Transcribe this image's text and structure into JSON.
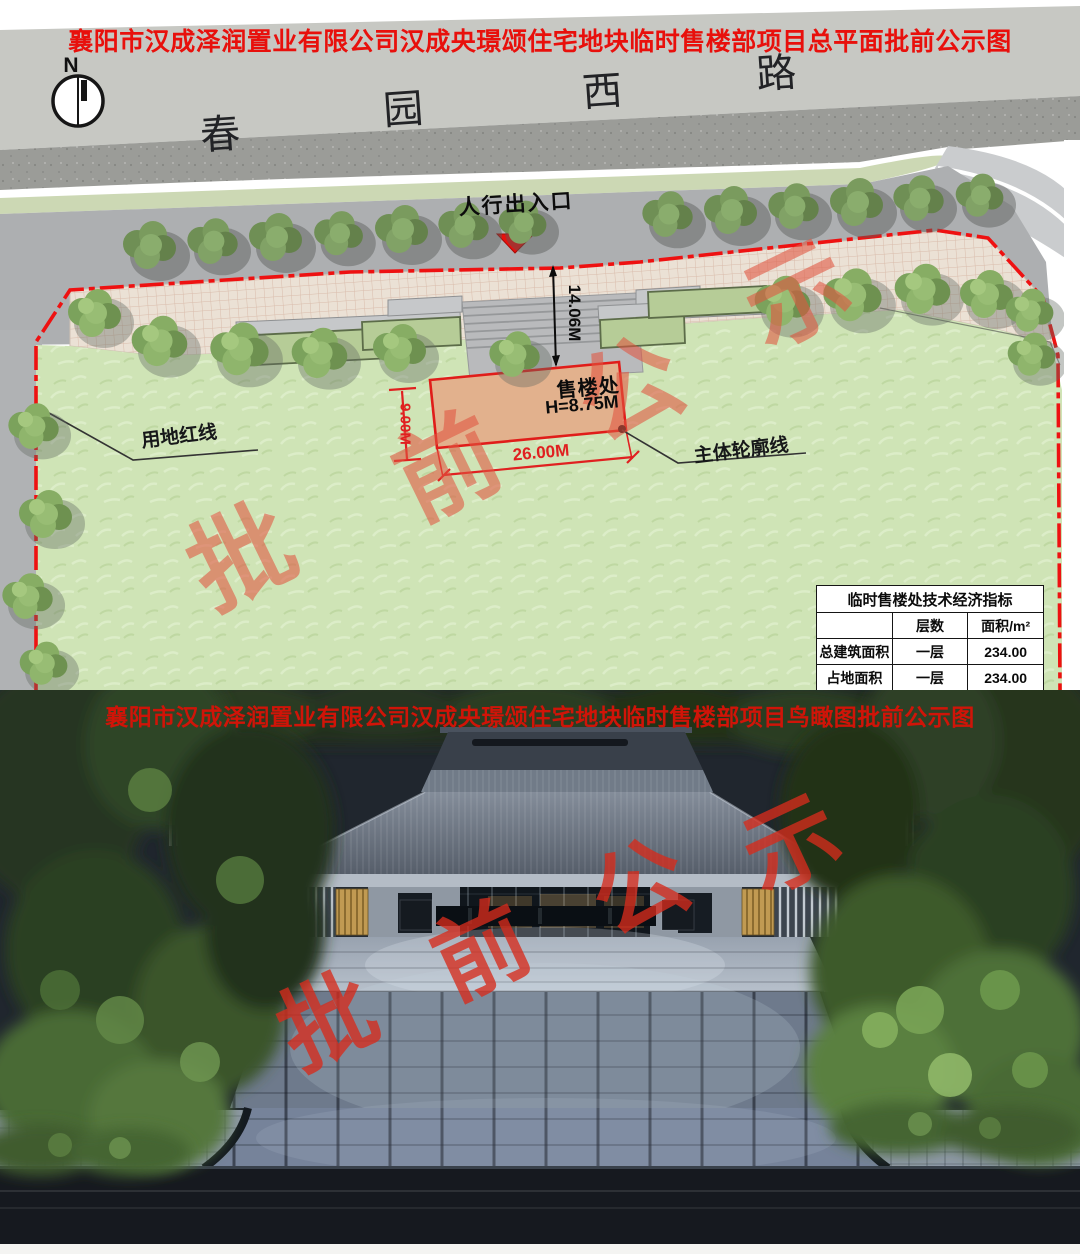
{
  "top_plan": {
    "title": "襄阳市汉成泽润置业有限公司汉成央璟颂住宅地块临时售楼部项目总平面批前公示图",
    "compass_label": "N",
    "road_name_chars": [
      "春",
      "园",
      "西",
      "路"
    ],
    "pedestrian_entrance_label": "人行出入口",
    "building_label": "售楼处",
    "building_height": "H=8.75M",
    "dim_depth": "14.06M",
    "dim_width": "26.00M",
    "dim_side": "9.00M",
    "red_line_label": "用地红线",
    "outline_label": "主体轮廓线",
    "table": {
      "title": "临时售楼处技术经济指标",
      "col_floors": "层数",
      "col_area": "面积/m²",
      "rows": [
        {
          "label": "总建筑面积",
          "floors": "一层",
          "area": "234.00"
        },
        {
          "label": "占地面积",
          "floors": "一层",
          "area": "234.00"
        }
      ]
    }
  },
  "bottom_render": {
    "title": "襄阳市汉成泽润置业有限公司汉成央璟颂住宅地块临时售楼部项目鸟瞰图批前公示图"
  },
  "watermark_chars": [
    "批",
    "前",
    "公",
    "示"
  ],
  "colors": {
    "title_red": "#e8100c",
    "boundary_red": "#ee1111",
    "dimension_red": "#e02020",
    "building_fill": "#e2b18d",
    "lawn_green": "#cfe4b6",
    "plaza_pink": "#ebe1d5",
    "watermark_red": "#e0503c",
    "render_roof_gray": "#6b7482",
    "render_gold": "#c19a52"
  }
}
